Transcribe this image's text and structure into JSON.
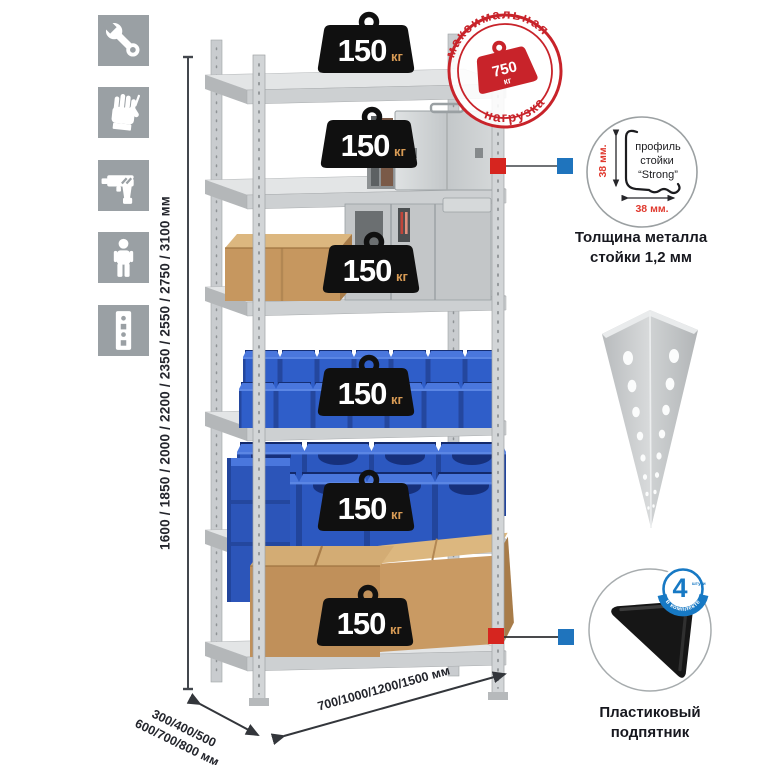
{
  "product": {
    "kind": "metal-shelving-rack-infographic"
  },
  "sidebar_icons": [
    {
      "name": "wrench-icon"
    },
    {
      "name": "gloves-icon"
    },
    {
      "name": "drill-icon"
    },
    {
      "name": "person-icon"
    },
    {
      "name": "rack-post-icon"
    }
  ],
  "dimensions": {
    "height": "1600 / 1850 / 2000 / 2200 / 2350 / 2550 / 2750 / 3100 мм",
    "depth_line1": "300/400/500",
    "depth_line2": "600/700/800 мм",
    "width": "700/1000/1200/1500 мм"
  },
  "max_load_stamp": {
    "arc_top": "максимальная",
    "arc_bottom": "нагрузка",
    "value": "750",
    "unit": "кг"
  },
  "shelf_badge": {
    "value": "150",
    "unit": "кг",
    "count": 6
  },
  "profile_callout": {
    "line1": "профиль",
    "line2": "стойки",
    "line3": "“Strong”",
    "dim_vertical": "38 мм.",
    "dim_horizontal": "38 мм.",
    "caption_line1": "Толщина металла",
    "caption_line2": "стойки 1,2 мм"
  },
  "foot_callout": {
    "badge_value": "4",
    "badge_small": "штуки",
    "badge_arc": "в комплекте",
    "caption_line1": "Пластиковый",
    "caption_line2": "подпятник"
  },
  "colors": {
    "stamp_red": "#c8232a",
    "marker_red": "#d6251f",
    "marker_blue": "#1f74bd",
    "bin_blue": "#2f5ec9",
    "cardboard": "#c6975f",
    "metal_gray": "#ccd0d2",
    "icon_bg": "#9aa0a4",
    "badge_black": "#101010",
    "dim_red": "#e0392e",
    "text_dark": "#23252c"
  }
}
